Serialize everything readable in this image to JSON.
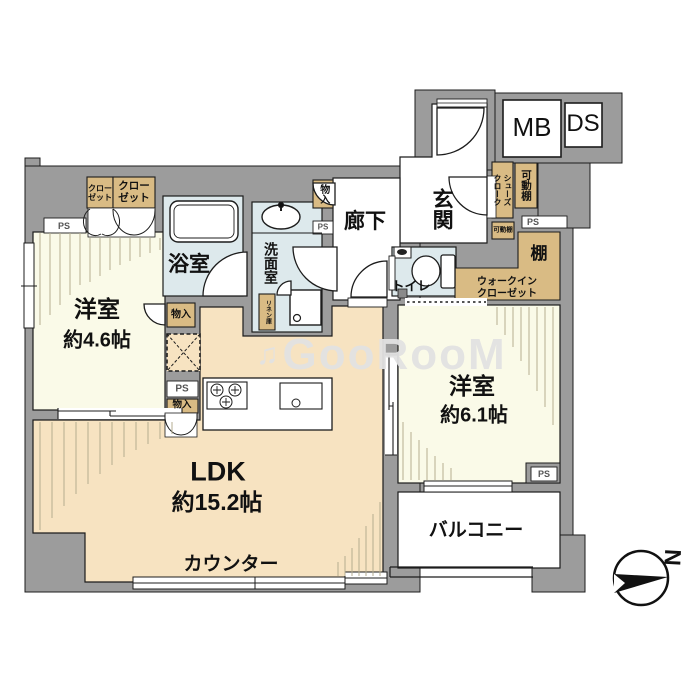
{
  "meta": {
    "type": "apartment-floorplan"
  },
  "rooms": {
    "ldk": {
      "name": "LDK",
      "size": "約15.2帖"
    },
    "bedroom_small": {
      "name": "洋室",
      "size": "約4.6帖"
    },
    "bedroom_large": {
      "name": "洋室",
      "size": "約6.1帖"
    },
    "balcony": "バルコニー",
    "counter": "カウンター",
    "bathroom": "浴室",
    "washroom": "洗面室",
    "hallway": "廊下",
    "entrance": "玄関",
    "toilet": "トイレ"
  },
  "storage": {
    "closet": "クロー\nゼット",
    "storage_small": "物入",
    "shoes_cloak": "シューズ\nクローク",
    "movable_shelf": "可動棚",
    "shelf": "棚",
    "walk_in_closet": "ウォークイン\nクローゼット",
    "linen": "リネン庫"
  },
  "facility_labels": {
    "ps": "PS",
    "mb": "MB",
    "ds": "DS"
  },
  "compass": {
    "north": "N"
  },
  "watermark": {
    "note": "♫",
    "text": "GooRooM"
  },
  "colors": {
    "wall": "#9c9c9c",
    "line": "#1c1c1c",
    "room_cream": "#fafae8",
    "room_tan": "#f7e3c1",
    "wet_blue": "#dde9ec",
    "storage_tan": "#d9bb84",
    "hatch": "#b5ad90",
    "watermark": "#e2e2e2"
  }
}
